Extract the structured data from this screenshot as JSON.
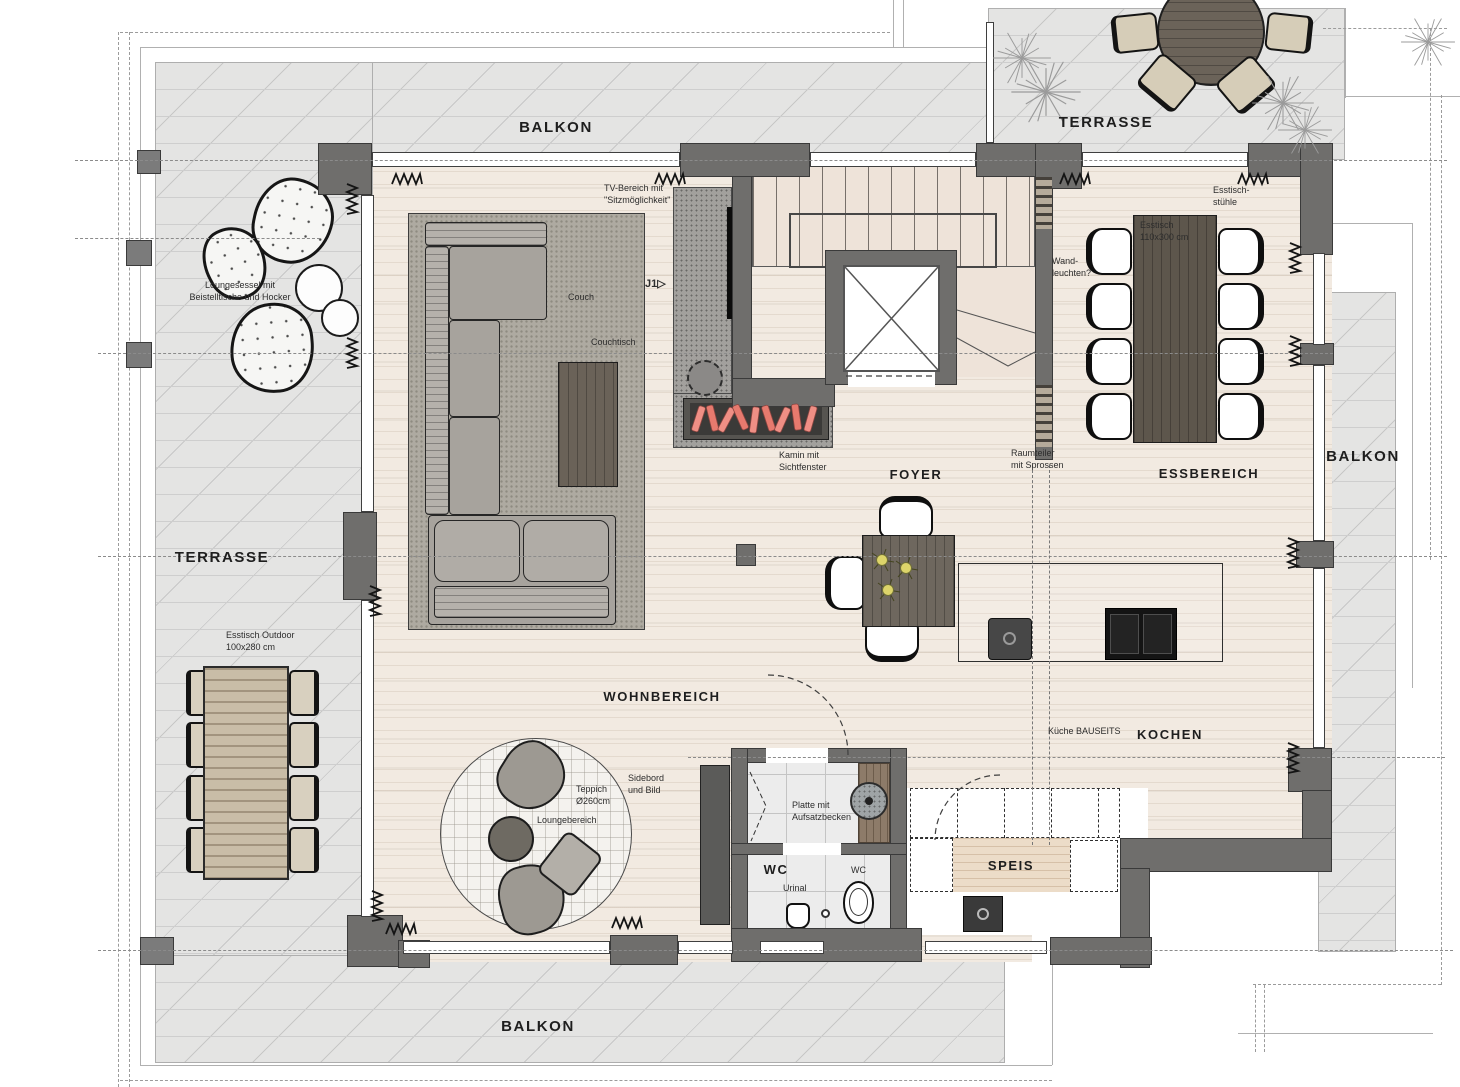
{
  "colors": {
    "wall": "#6f6e6c",
    "terrace_floor": "#e4e4e3",
    "wood_floor": "#f2eae1",
    "carpet": "#aeaaa1",
    "concrete": "#a2a09d",
    "table_wood": "#5d564c",
    "fireplace_logs": "#ef8f85",
    "outdoor_chair": "#d6cdb8"
  },
  "area_labels": [
    {
      "id": "balkon-top",
      "text": "BALKON",
      "x": 556,
      "y": 119,
      "size": 15
    },
    {
      "id": "terrasse-top-right",
      "text": "TERRASSE",
      "x": 1106,
      "y": 114,
      "size": 15
    },
    {
      "id": "terrasse-left",
      "text": "TERRASSE",
      "x": 222,
      "y": 549,
      "size": 15
    },
    {
      "id": "balkon-right",
      "text": "BALKON",
      "x": 1363,
      "y": 448,
      "size": 15
    },
    {
      "id": "balkon-bottom",
      "text": "BALKON",
      "x": 538,
      "y": 1018,
      "size": 15
    },
    {
      "id": "wohnbereich",
      "text": "WOHNBEREICH",
      "x": 662,
      "y": 689,
      "size": 13
    },
    {
      "id": "essbereich",
      "text": "ESSBEREICH",
      "x": 1209,
      "y": 466,
      "size": 13
    },
    {
      "id": "foyer",
      "text": "FOYER",
      "x": 916,
      "y": 467,
      "size": 13
    },
    {
      "id": "kochen",
      "text": "KOCHEN",
      "x": 1170,
      "y": 727,
      "size": 13
    },
    {
      "id": "speis",
      "text": "SPEIS",
      "x": 1011,
      "y": 858,
      "size": 13
    },
    {
      "id": "wc-room",
      "text": "WC",
      "x": 776,
      "y": 862,
      "size": 13
    }
  ],
  "annotations": [
    {
      "id": "loungesessel",
      "text": "Loungesessel mit\nBeistelltische und Hocker",
      "x": 240,
      "y": 280,
      "align": "center"
    },
    {
      "id": "tv-bereich",
      "text": "TV-Bereich mit\n\"Sitzmöglichkeit\"",
      "x": 604,
      "y": 183,
      "align": "left"
    },
    {
      "id": "couch",
      "text": "Couch",
      "x": 568,
      "y": 292,
      "align": "left"
    },
    {
      "id": "couchtisch",
      "text": "Couchtisch",
      "x": 591,
      "y": 337,
      "align": "left"
    },
    {
      "id": "j1-marker",
      "text": "J1▷",
      "x": 645,
      "y": 277,
      "align": "left",
      "bold": true,
      "size": 11
    },
    {
      "id": "kamin",
      "text": "Kamin mit\nSichtfenster",
      "x": 779,
      "y": 450,
      "align": "left"
    },
    {
      "id": "raumteiler",
      "text": "Raumteiler\nmit Sprossen",
      "x": 1011,
      "y": 448,
      "align": "left"
    },
    {
      "id": "esstisch-stuehle",
      "text": "Esstisch-\nstühle",
      "x": 1213,
      "y": 185,
      "align": "left"
    },
    {
      "id": "esstisch",
      "text": "Esstisch\n110x300 cm",
      "x": 1140,
      "y": 220,
      "align": "left"
    },
    {
      "id": "wandleuchten",
      "text": "Wand-\nleuchten?",
      "x": 1052,
      "y": 256,
      "align": "left"
    },
    {
      "id": "esstisch-outdoor",
      "text": "Esstisch Outdoor\n100x280 cm",
      "x": 226,
      "y": 630,
      "align": "left"
    },
    {
      "id": "teppich",
      "text": "Teppich\nØ260cm",
      "x": 576,
      "y": 784,
      "align": "left"
    },
    {
      "id": "loungebereich",
      "text": "Loungebereich",
      "x": 537,
      "y": 815,
      "align": "left"
    },
    {
      "id": "sidebord",
      "text": "Sidebord\nund Bild",
      "x": 628,
      "y": 773,
      "align": "left"
    },
    {
      "id": "platte",
      "text": "Platte mit\nAufsatzbecken",
      "x": 792,
      "y": 800,
      "align": "left"
    },
    {
      "id": "wc-small",
      "text": "WC",
      "x": 851,
      "y": 865,
      "align": "left"
    },
    {
      "id": "urinal",
      "text": "Urinal",
      "x": 783,
      "y": 883,
      "align": "left"
    },
    {
      "id": "kueche-bauseits",
      "text": "Küche BAUSEITS",
      "x": 1048,
      "y": 726,
      "align": "left"
    }
  ]
}
